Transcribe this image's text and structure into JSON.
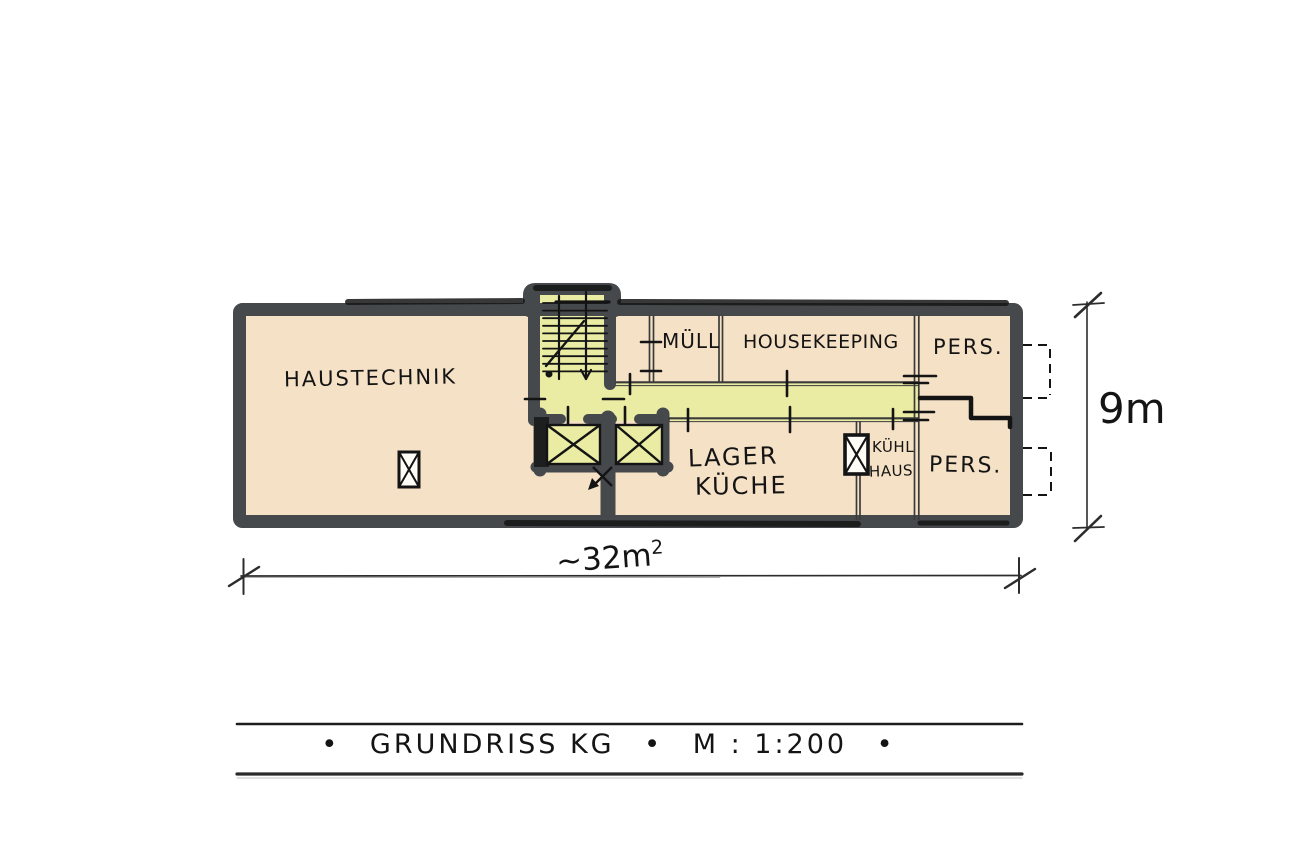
{
  "floor_plan": {
    "rooms": {
      "haustechnik": {
        "label": "HAUSTECHNIK"
      },
      "muell": {
        "label": "MÜLL"
      },
      "housekeeping": {
        "label": "HOUSEKEEPING"
      },
      "pers_upper": {
        "label": "PERS."
      },
      "lager_kueche": {
        "line1": "LAGER",
        "line2": "KÜCHE"
      },
      "kuehlhaus": {
        "line1": "KÜHL",
        "line2": "HAUS"
      },
      "pers_lower": {
        "label": "PERS."
      }
    },
    "dimensions": {
      "height_label": "9m",
      "width_label": "~32m",
      "width_sup": "2"
    },
    "title_block": {
      "bullet": "•",
      "drawing_title": "GRUNDRISS KG",
      "scale": "M : 1:200"
    },
    "colors": {
      "wall": "#45494b",
      "room_fill": "#f5e1c6",
      "circulation_fill": "#e9eca2",
      "ink": "#141414"
    }
  }
}
